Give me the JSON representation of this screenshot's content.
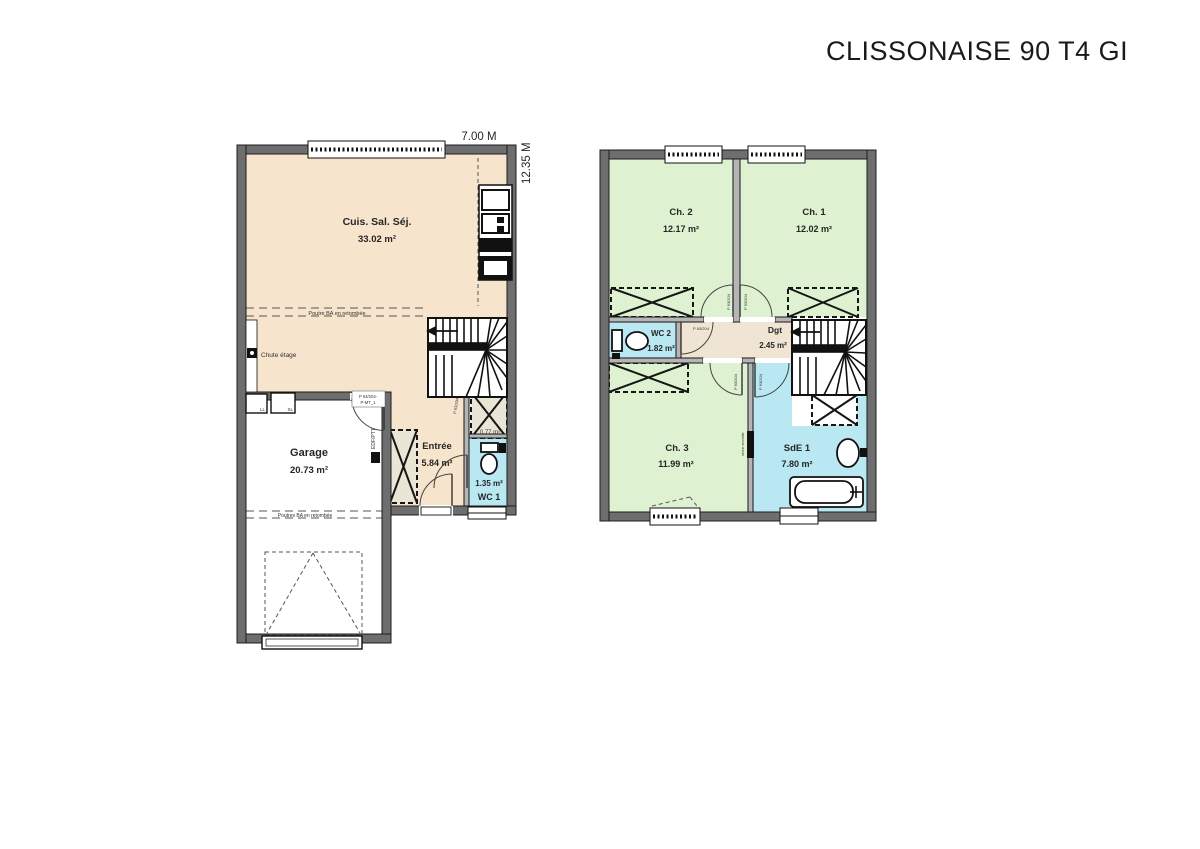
{
  "title": "CLISSONAISE 90 T4 GI",
  "dimensions": {
    "width_label": "7.00 M",
    "height_label": "12.35 M"
  },
  "colors": {
    "living": "#f7e4cc",
    "bedroom": "#def2d1",
    "wet": "#b9e7f2",
    "hall": "#efe5d2",
    "closet": "#e9e6d6",
    "garage": "#ffffff"
  },
  "ground_floor": {
    "rooms": [
      {
        "name": "Cuis. Sal. Séj.",
        "area": "33.02 m²"
      },
      {
        "name": "Garage",
        "area": "20.73 m²"
      },
      {
        "name": "Entrée",
        "area": "5.84 m²"
      },
      {
        "name": "WC 1",
        "area": "1.35 m²"
      },
      {
        "name": "Placard",
        "area": "0.77 m²"
      }
    ],
    "annotations": {
      "beam_single": "Poutre BA en retombée",
      "beam_plural": "Poutres BA en retombée",
      "chute": "Chute étage",
      "edf": "EDF/PTT",
      "ll": "LL",
      "sl": "SL",
      "garage_door_label1": "P 63/204-",
      "garage_door_label2": "P-MT_1",
      "door_label": "P 63/204"
    }
  },
  "first_floor": {
    "rooms": [
      {
        "name": "Ch. 2",
        "area": "12.17 m²"
      },
      {
        "name": "Ch. 1",
        "area": "12.02 m²"
      },
      {
        "name": "WC 2",
        "area": "1.82 m²"
      },
      {
        "name": "Dgt",
        "area": "2.45 m²"
      },
      {
        "name": "Ch. 3",
        "area": "11.99 m²"
      },
      {
        "name": "SdE 1",
        "area": "7.80 m²"
      }
    ],
    "annotations": {
      "door_label": "P 63/204",
      "towel": "sèche serviette"
    }
  }
}
